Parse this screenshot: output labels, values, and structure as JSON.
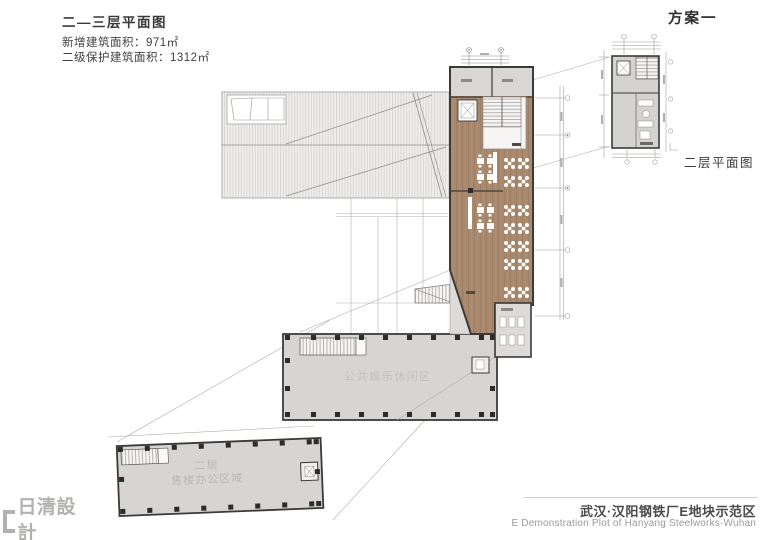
{
  "header": {
    "plan_title": "二—三层平面图",
    "new_area": "新增建筑面积：971㎡",
    "protected_area": "二级保护建筑面积：1312㎡",
    "scheme": "方案一"
  },
  "plans": {
    "small_plan_label": "二层平面图",
    "public_zone_label": "公共娱乐休闲区",
    "floor2_label_line1": "二层",
    "floor2_label_line2": "售楼办公区域"
  },
  "footer": {
    "project_title_cn": "武汉·汉阳钢铁厂E地块示范区",
    "project_title_en": "E Demonstration Plot of Hanyang Steelworks·Wuhan",
    "logo_text": "日清設計",
    "logo_subtitle": "ARCHITECTURAL DESIGN"
  },
  "colors": {
    "wood_floor": "#a8896d",
    "floor_gray": "#d6d5d3",
    "wall_dark": "#3c3a38",
    "hatch_line": "#cfcecb",
    "text_dark": "#3a3a3a",
    "text_light": "#b9b8b6"
  }
}
